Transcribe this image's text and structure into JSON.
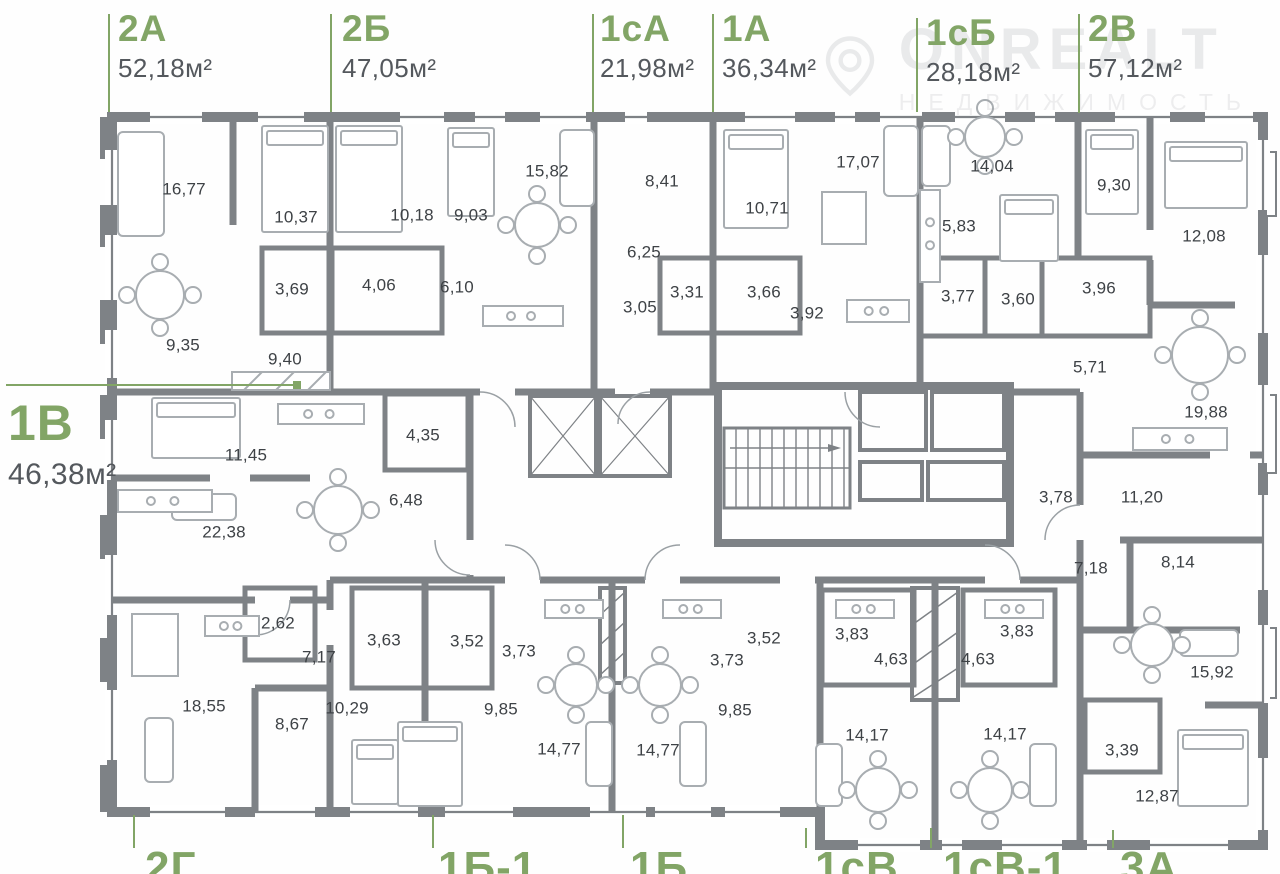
{
  "watermark": {
    "brand": "ONREALT",
    "tagline": "НЕДВИЖИМОСТЬ"
  },
  "colors": {
    "accent_green": "#82a566",
    "area_text": "#54585d",
    "room_text": "#3e4246",
    "wall_gray": "#7e8286",
    "furniture_gray": "#a8adb1"
  },
  "units": [
    {
      "id": "2А",
      "area": "52,18м²",
      "rooms": [
        [
          "16,77",
          184,
          190
        ],
        [
          "10,37",
          296,
          218
        ],
        [
          "3,69",
          292,
          290
        ],
        [
          "4,06",
          379,
          286
        ],
        [
          "9,35",
          183,
          346
        ],
        [
          "9,40",
          285,
          360
        ]
      ]
    },
    {
      "id": "2Б",
      "area": "47,05м²",
      "rooms": [
        [
          "15,82",
          547,
          172
        ],
        [
          "10,18",
          412,
          216
        ],
        [
          "9,03",
          471,
          216
        ],
        [
          "6,10",
          457,
          288
        ]
      ]
    },
    {
      "id": "1сА",
      "area": "21,98м²",
      "rooms": [
        [
          "8,41",
          662,
          182
        ],
        [
          "6,25",
          644,
          253
        ],
        [
          "3,05",
          640,
          308
        ],
        [
          "3,31",
          687,
          293
        ]
      ]
    },
    {
      "id": "1А",
      "area": "36,34м²",
      "rooms": [
        [
          "17,07",
          858,
          163
        ],
        [
          "10,71",
          767,
          209
        ],
        [
          "3,66",
          764,
          293
        ],
        [
          "3,92",
          807,
          314
        ]
      ]
    },
    {
      "id": "1сБ",
      "area": "28,18м²",
      "rooms": [
        [
          "14,04",
          992,
          167
        ],
        [
          "5,83",
          959,
          227
        ],
        [
          "3,77",
          958,
          297
        ],
        [
          "3,60",
          1018,
          300
        ]
      ]
    },
    {
      "id": "2В",
      "area": "57,12м²",
      "rooms": [
        [
          "9,30",
          1114,
          186
        ],
        [
          "12,08",
          1204,
          237
        ],
        [
          "3,96",
          1099,
          289
        ],
        [
          "5,71",
          1090,
          368
        ],
        [
          "19,88",
          1206,
          413
        ]
      ]
    },
    {
      "id": "1В",
      "area": "46,38м²",
      "rooms": [
        [
          "11,45",
          246,
          456
        ],
        [
          "4,35",
          423,
          436
        ],
        [
          "6,48",
          406,
          501
        ],
        [
          "22,38",
          224,
          533
        ]
      ]
    },
    {
      "id": "2Г",
      "rooms": [
        [
          "2,62",
          278,
          624
        ],
        [
          "7,17",
          319,
          658
        ],
        [
          "18,55",
          204,
          707
        ],
        [
          "10,29",
          347,
          709
        ],
        [
          "8,67",
          292,
          725
        ]
      ]
    },
    {
      "id": "1Б-1",
      "rooms": [
        [
          "3,63",
          384,
          641
        ],
        [
          "3,52",
          467,
          642
        ],
        [
          "3,73",
          519,
          652
        ],
        [
          "9,85",
          501,
          710
        ],
        [
          "14,77",
          559,
          750
        ]
      ]
    },
    {
      "id": "1Б",
      "rooms": [
        [
          "3,52",
          764,
          639
        ],
        [
          "3,73",
          727,
          661
        ],
        [
          "9,85",
          735,
          711
        ],
        [
          "14,77",
          658,
          751
        ]
      ]
    },
    {
      "id": "1сВ",
      "rooms": [
        [
          "3,83",
          852,
          635
        ],
        [
          "4,63",
          891,
          660
        ],
        [
          "14,17",
          867,
          736
        ]
      ]
    },
    {
      "id": "1сВ-1",
      "rooms": [
        [
          "3,83",
          1017,
          632
        ],
        [
          "4,63",
          978,
          660
        ],
        [
          "14,17",
          1005,
          735
        ]
      ]
    },
    {
      "id": "3А",
      "rooms": [
        [
          "3,78",
          1056,
          498
        ],
        [
          "11,20",
          1142,
          498
        ],
        [
          "7,18",
          1091,
          569
        ],
        [
          "8,14",
          1178,
          563
        ],
        [
          "15,92",
          1212,
          673
        ],
        [
          "3,39",
          1122,
          751
        ],
        [
          "12,87",
          1157,
          797
        ]
      ]
    }
  ]
}
